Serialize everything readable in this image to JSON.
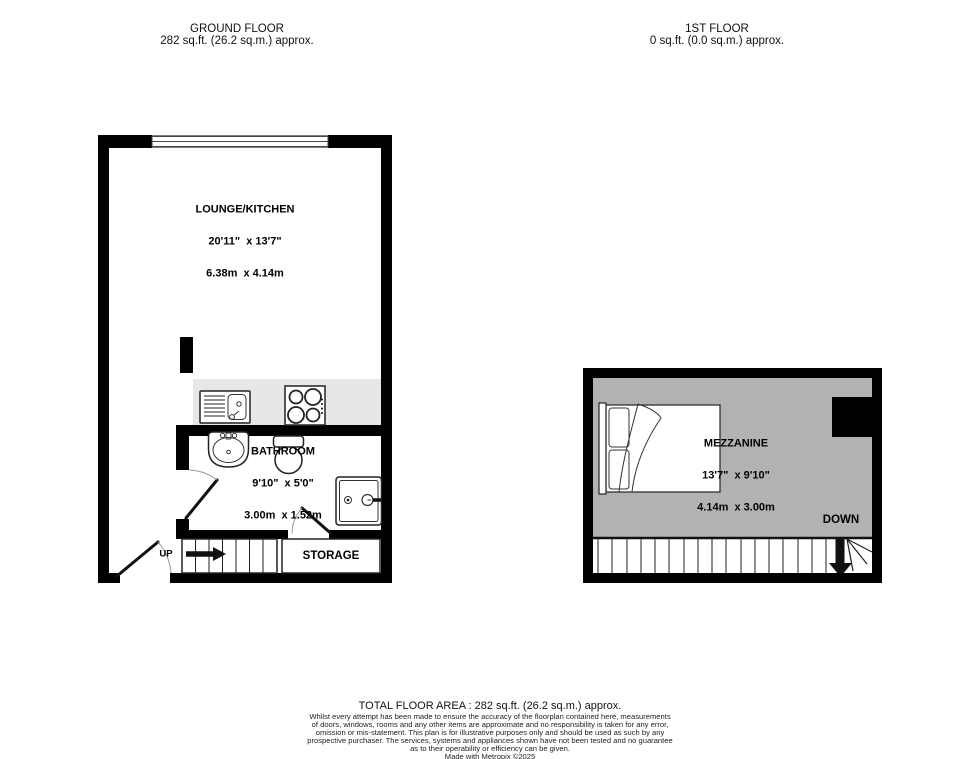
{
  "headers": {
    "ground_floor": {
      "title": "GROUND FLOOR",
      "area": "282 sq.ft. (26.2 sq.m.) approx."
    },
    "first_floor": {
      "title": "1ST FLOOR",
      "area": "0 sq.ft. (0.0 sq.m.) approx."
    }
  },
  "rooms": {
    "lounge_kitchen": {
      "name": "LOUNGE/KITCHEN",
      "dims_imperial": "20'11\"  x 13'7\"",
      "dims_metric": "6.38m  x 4.14m"
    },
    "bathroom": {
      "name": "BATHROOM",
      "dims_imperial": "9'10\"  x 5'0\"",
      "dims_metric": "3.00m  x 1.52m"
    },
    "mezzanine": {
      "name": "MEZZANINE",
      "dims_imperial": "13'7\"  x 9'10\"",
      "dims_metric": "4.14m  x 3.00m"
    },
    "storage": {
      "name": "STORAGE"
    }
  },
  "stairs": {
    "ground_label": "UP",
    "mezzanine_label": "DOWN"
  },
  "footer": {
    "total_area": "TOTAL FLOOR AREA : 282 sq.ft. (26.2 sq.m.) approx.",
    "disclaimer_lines": [
      "Whilst every attempt has been made to ensure the accuracy of the floorplan contained here, measurements",
      "of doors, windows, rooms and any other items are approximate and no responsibility is taken for any error,",
      "omission or mis-statement. This plan is for illustrative purposes only and should be used as such by any",
      "prospective purchaser. The services, systems and appliances shown have not been tested and no guarantee",
      "as to their operability or efficiency can be given."
    ],
    "credit": "Made with Metropix ©2025"
  },
  "colors": {
    "wall": "#000000",
    "counter": "#e7e7e7",
    "mezzanine_floor": "#b2b2b2",
    "background": "#ffffff"
  }
}
